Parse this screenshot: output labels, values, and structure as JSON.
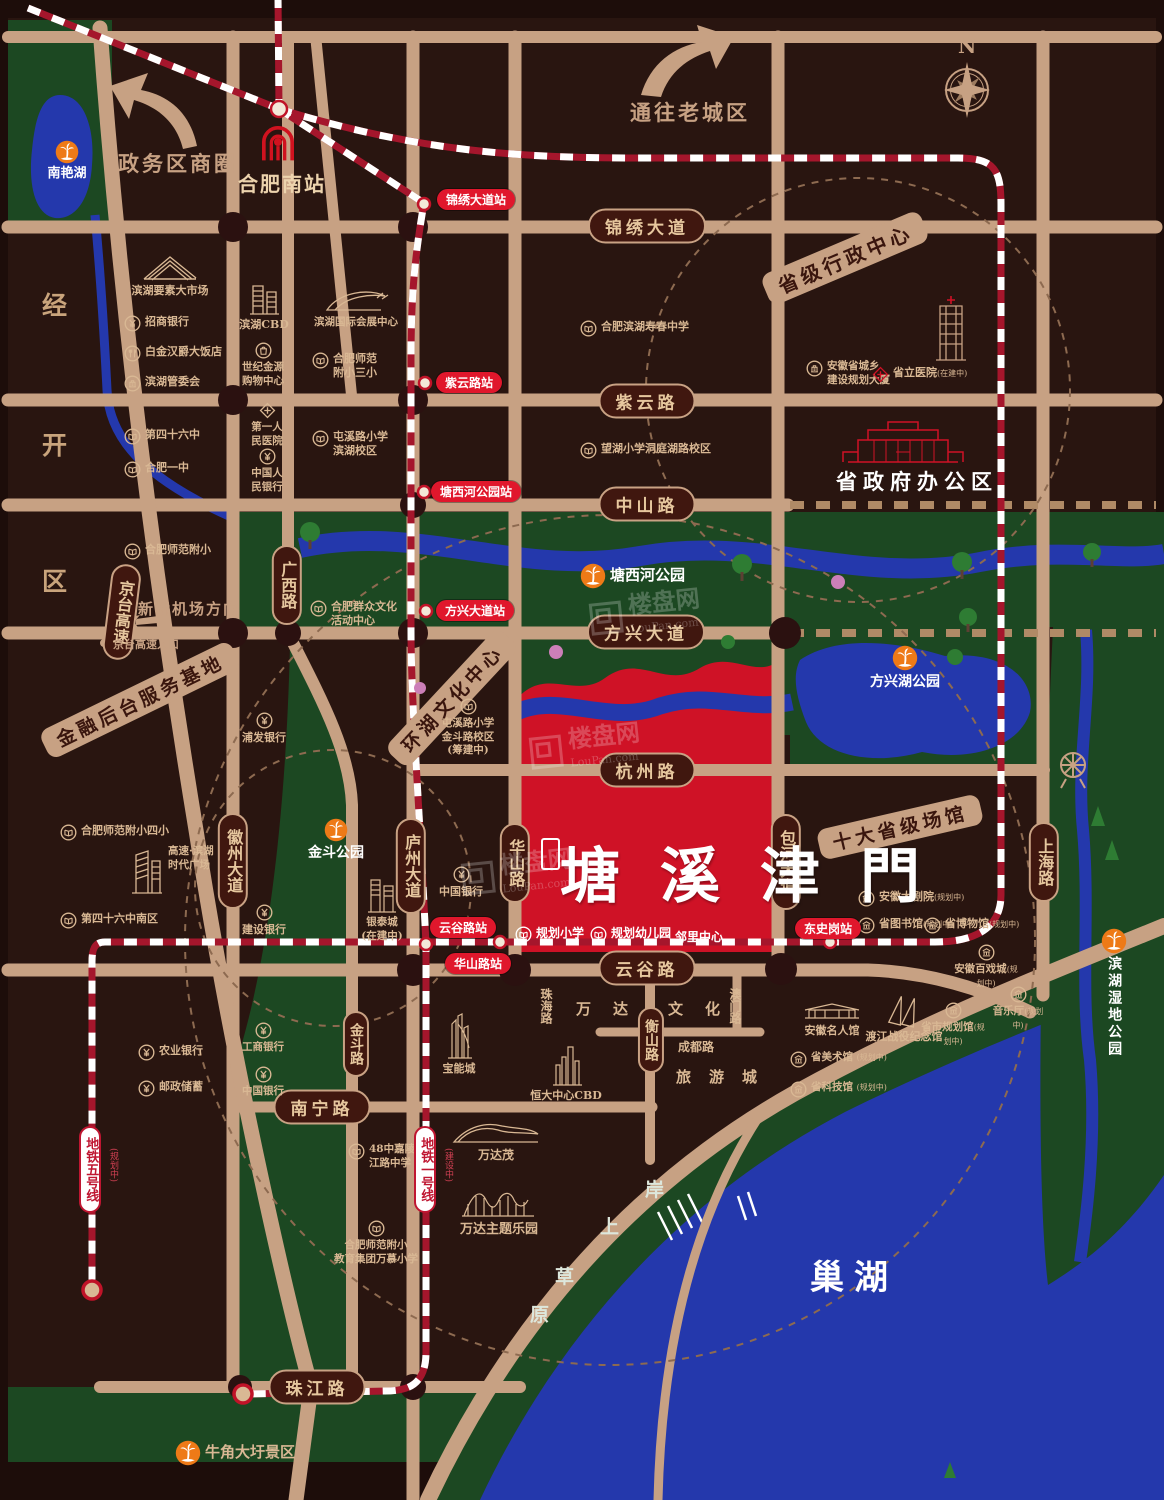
{
  "site": {
    "name": "塘溪津門",
    "school": "规划小学",
    "kindergarten": "规划幼儿园",
    "neighborhood": "邻里中心"
  },
  "watermark": {
    "brand": "楼盘网",
    "domain": "LouPan.com"
  },
  "compass": {
    "north": "N"
  },
  "arrows": {
    "gov_cbd": "政务区商圈",
    "old_town": "通往老城区",
    "airport": "新桥机场方向"
  },
  "banners": {
    "admin_center": "省级行政中心",
    "finance_base": "金融后台服务基地",
    "lake_culture": "环湖文化中心",
    "venues": "十大省级场馆"
  },
  "district": {
    "c0": "经",
    "c1": "开",
    "c2": "区"
  },
  "grass": {
    "c0": "岸",
    "c1": "上",
    "c2": "草",
    "c3": "原"
  },
  "water": {
    "chaohu": "巢湖"
  },
  "parks": {
    "nanyanhu": "南艳湖",
    "tangxihe": "塘西河公园",
    "fangxinghu": "方兴湖公园",
    "jindou": "金斗公园",
    "niujiao": "牛角大圩景区",
    "shidi": "滨湖湿地公园"
  },
  "roads": {
    "jinxiu": "锦绣大道",
    "ziyun": "紫云路",
    "zhongshan": "中山路",
    "fangxing": "方兴大道",
    "hangzhou": "杭州路",
    "yungu": "云谷路",
    "nanning": "南宁路",
    "zhujiang": "珠江路",
    "jingtai": "京台高速",
    "guangxi": "广西路",
    "huizhou": "徽州大道",
    "luzhou": "庐州大道",
    "huashan": "华山路",
    "baohe": "包河大道",
    "shanghai": "上海路",
    "jindou": "金斗路",
    "hengshan": "衡山路",
    "chengdu": "成都路",
    "aomen": "澳门路",
    "zhuhai": "珠海路"
  },
  "areas": {
    "wanda": "万达",
    "wenhua": "文化",
    "lvyou": "旅游城"
  },
  "stations": {
    "hfnz": "合肥南站",
    "jinxiu": "锦绣大道站",
    "ziyun": "紫云路站",
    "txh": "塘西河公园站",
    "fangxing": "方兴大道站",
    "yungu": "云谷路站",
    "huashan": "华山路站",
    "dsg": "东史岗站"
  },
  "metro": {
    "line1": "地铁一号线",
    "line1_status": "(建设中)",
    "line5": "地铁五号线",
    "line5_status": "(规划中)"
  },
  "notes": {
    "jingtai_entry": "京台高速入口"
  },
  "pois": {
    "ysdsc": "滨湖要素大市场",
    "zsyh": "招商银行",
    "bjhj": "白金汉爵大饭店",
    "bhgwh": "滨湖管委会",
    "bhcbd": "滨湖CBD",
    "sjjy": "世纪金源\n购物中心",
    "hzzx": "滨湖国际会展中心",
    "sfsx": "合肥师范\n附小三小",
    "d46z": "第四十六中",
    "hfyz": "合肥一中",
    "dyrm": "第一人\n民医院",
    "zgrmyh": "中国人\n民银行",
    "txlxx": "屯溪路小学\n滨湖校区",
    "sffx": "合肥师范附小",
    "shouchun": "合肥滨湖寿春中学",
    "wanghu": "望湖小学洞庭湖路校区",
    "ahgh": "安徽省城乡\n建设规划大厦",
    "slyy": "省立医院",
    "slyy_sub": "(在建中)",
    "qunzhong": "合肥群众文化\n活动中心",
    "pfyh": "浦发银行",
    "txl_jdl": "屯溪路小学\n金斗路校区\n(筹建中)",
    "zgyh": "中国银行",
    "jsyh": "建设银行",
    "gssd": "高速·滨湖\n时代广场",
    "d46zn": "第四十六中南区",
    "sffx4": "合肥师范附小四小",
    "yintai": "银泰城\n(在建中)",
    "baoneng": "宝能城",
    "hengda": "恒大中心CBD",
    "wandamao": "万达茂",
    "wandapark": "万达主题乐园",
    "z48": "48中嘉陵\n江路中学",
    "wanmu": "合肥师范附小\n教育集团万慕小学",
    "nyyh": "农业银行",
    "yzcx": "邮政储蓄",
    "gsyh": "工商银行",
    "zgyh2": "中国银行",
    "dajuyuan": "安徽大剧院",
    "dajuyuan_sub": "(规划中)",
    "tushuguan": "省图书馆",
    "tushuguan_sub": "(规划中)",
    "bowuguan": "省博物馆",
    "bowuguan_sub": "(规划中)",
    "baixicheng": "安徽百戏城",
    "baixicheng_sub": "(规划中)",
    "yinyueting": "音乐厅",
    "yinyueting_sub": "(规划中)",
    "guihuaguan": "省市规划馆",
    "guihuaguan_sub": "(规划中)",
    "mingrenguan": "安徽名人馆",
    "dujiang": "渡江战役纪念馆",
    "meishuguan": "省美术馆",
    "meishuguan_sub": "(规划中)",
    "kejiguan": "省科技馆",
    "kejiguan_sub": "(规划中)",
    "govt": "省政府办公区"
  },
  "colors": {
    "road": "#c7a183",
    "park_green": "#1c4822",
    "water_blue": "#2438ac",
    "site_red": "#cf1226",
    "metro_red": "#a5162c",
    "station_red": "#e0172c",
    "palm_orange": "#ee7a17",
    "bg": "#291510"
  }
}
